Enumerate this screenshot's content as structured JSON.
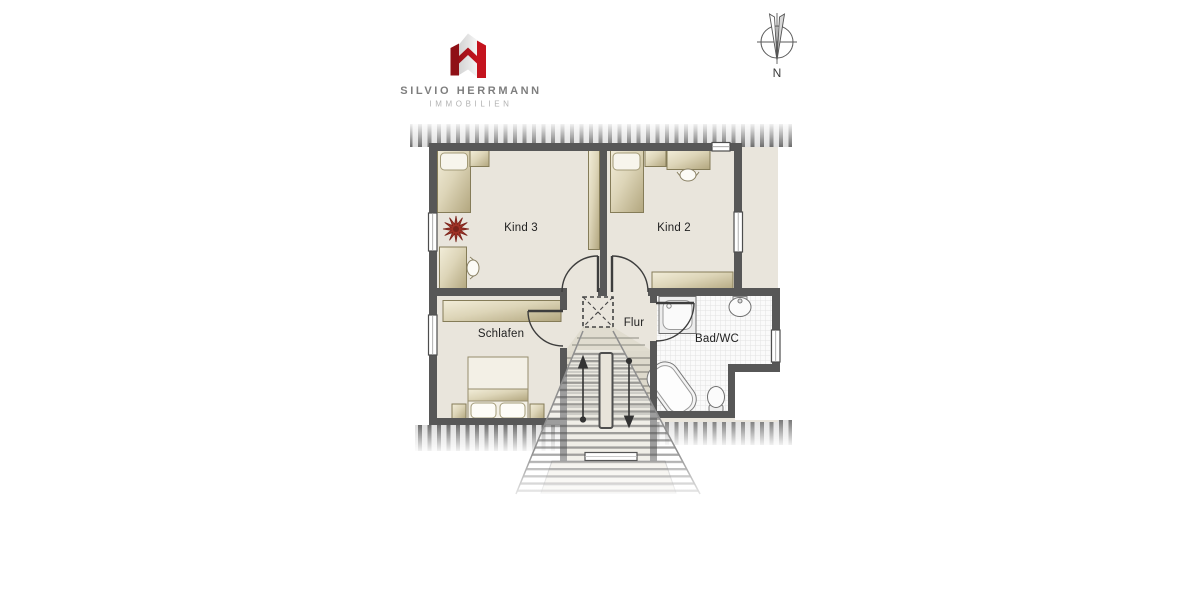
{
  "brand": {
    "name": "SILVIO HERRMANN",
    "division": "IMMOBILIEN",
    "logo_red": "#c4131e",
    "logo_red_dark": "#8e1016"
  },
  "compass": {
    "north_label": "N"
  },
  "floorplan": {
    "rooms": [
      {
        "id": "kind3",
        "label": "Kind 3"
      },
      {
        "id": "kind2",
        "label": "Kind 2"
      },
      {
        "id": "schlafen",
        "label": "Schlafen"
      },
      {
        "id": "flur",
        "label": "Flur"
      },
      {
        "id": "badwc",
        "label": "Bad/WC"
      }
    ],
    "colors": {
      "wall": "#575757",
      "floor": "#e9e5dc",
      "furniture": "#cfc5a3",
      "plant_red": "#a03226",
      "tile": "#fafafa"
    }
  }
}
